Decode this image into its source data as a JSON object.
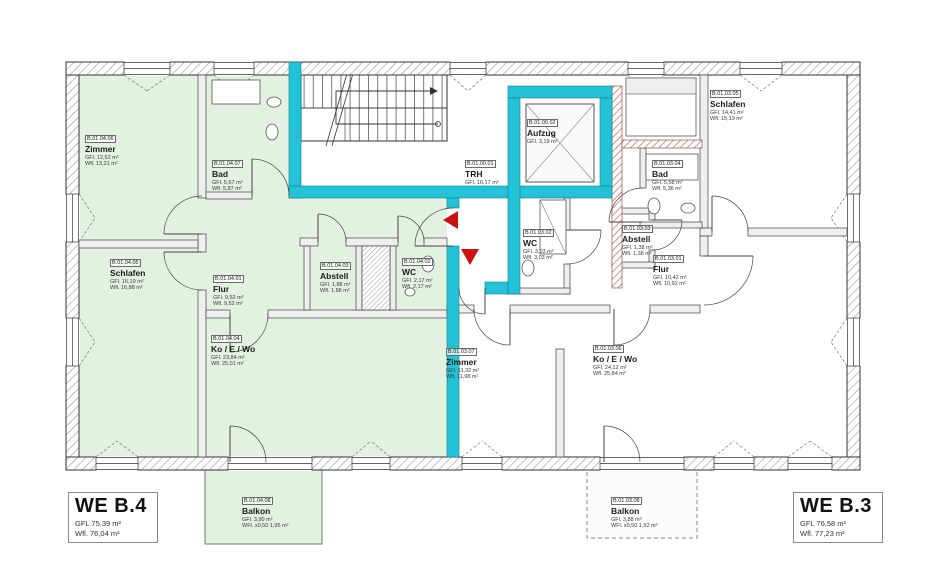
{
  "apartments": {
    "left": {
      "name": "WE B.4",
      "gfl": "GFL 75,39 m²",
      "wfl": "Wfl. 76,04 m²"
    },
    "right": {
      "name": "WE B.3",
      "gfl": "GFL 76,58 m²",
      "wfl": "Wfl. 77,23 m²"
    }
  },
  "rooms": [
    {
      "number": "B.01.04.06",
      "name": "Zimmer",
      "line1": "GFl. 12,52 m²",
      "line2": "Wfl. 13,21 m²"
    },
    {
      "number": "B.01.04.07",
      "name": "Bad",
      "line1": "GFl. 5,67 m²",
      "line2": "Wfl. 5,87 m²"
    },
    {
      "number": "B.01.04.05",
      "name": "Schlafen",
      "line1": "GFl. 16,19 m²",
      "line2": "Wfl. 16,88 m²"
    },
    {
      "number": "B.01.04.01",
      "name": "Flur",
      "line1": "GFl. 9,52 m²",
      "line2": "Wfl. 9,52 m²"
    },
    {
      "number": "B.01.04.03",
      "name": "Abstell",
      "line1": "GFl. 1,88 m²",
      "line2": "Wfl. 1,88 m²"
    },
    {
      "number": "B.01.04.02",
      "name": "WC",
      "line1": "GFl. 2,17 m²",
      "line2": "Wfl. 2,17 m²"
    },
    {
      "number": "B.01.04.04",
      "name": "Ko / E / Wo",
      "line1": "GFl. 23,84 m²",
      "line2": "Wfl. 25,01 m²"
    },
    {
      "number": "B.01.04.08",
      "name": "Balkon",
      "line1": "GFl. 3,90 m²",
      "line2": "WFl. x0,50 1,95 m²"
    },
    {
      "number": "B.01.00.01",
      "name": "TRH",
      "line1": "GFl. 16,17 m²",
      "line2": ""
    },
    {
      "number": "B.01.00.02",
      "name": "Aufzug",
      "line1": "GFl. 3,19 m²",
      "line2": ""
    },
    {
      "number": "B.01.03.02",
      "name": "WC",
      "line1": "GFl. 3,03 m²",
      "line2": "Wfl. 3,03 m²"
    },
    {
      "number": "B.01.03.03",
      "name": "Abstell",
      "line1": "GFl. 1,38 m²",
      "line2": "Wfl. 1,38 m²"
    },
    {
      "number": "B.01.03.01",
      "name": "Flur",
      "line1": "GFl. 10,42 m²",
      "line2": "Wfl. 10,92 m²"
    },
    {
      "number": "B.01.03.05",
      "name": "Schlafen",
      "line1": "GFl. 14,41 m²",
      "line2": "Wfl. 15,19 m²"
    },
    {
      "number": "B.01.03.04",
      "name": "Bad",
      "line1": "GFl. 5,58 m²",
      "line2": "Wfl. 5,36 m²"
    },
    {
      "number": "B.01.03.07",
      "name": "Zimmer",
      "line1": "GFl. 11,32 m²",
      "line2": "Wfl. 11,98 m²"
    },
    {
      "number": "B.01.03.06",
      "name": "Ko / E / Wo",
      "line1": "GFl. 24,12 m²",
      "line2": "Wfl. 25,84 m²"
    },
    {
      "number": "B.01.03.08",
      "name": "Balkon",
      "line1": "GFl. 3,88 m²",
      "line2": "WFl. x0,50 1,92 m²"
    }
  ],
  "colors": {
    "apartment_fill_green": "#e3f1e1",
    "core_wall_cyan": "#24c2d7",
    "arrow_red": "#cc1111",
    "outer_wall_hatch_gray": "#8f8f8f",
    "masonry_hatch_red": "#b1544b"
  }
}
